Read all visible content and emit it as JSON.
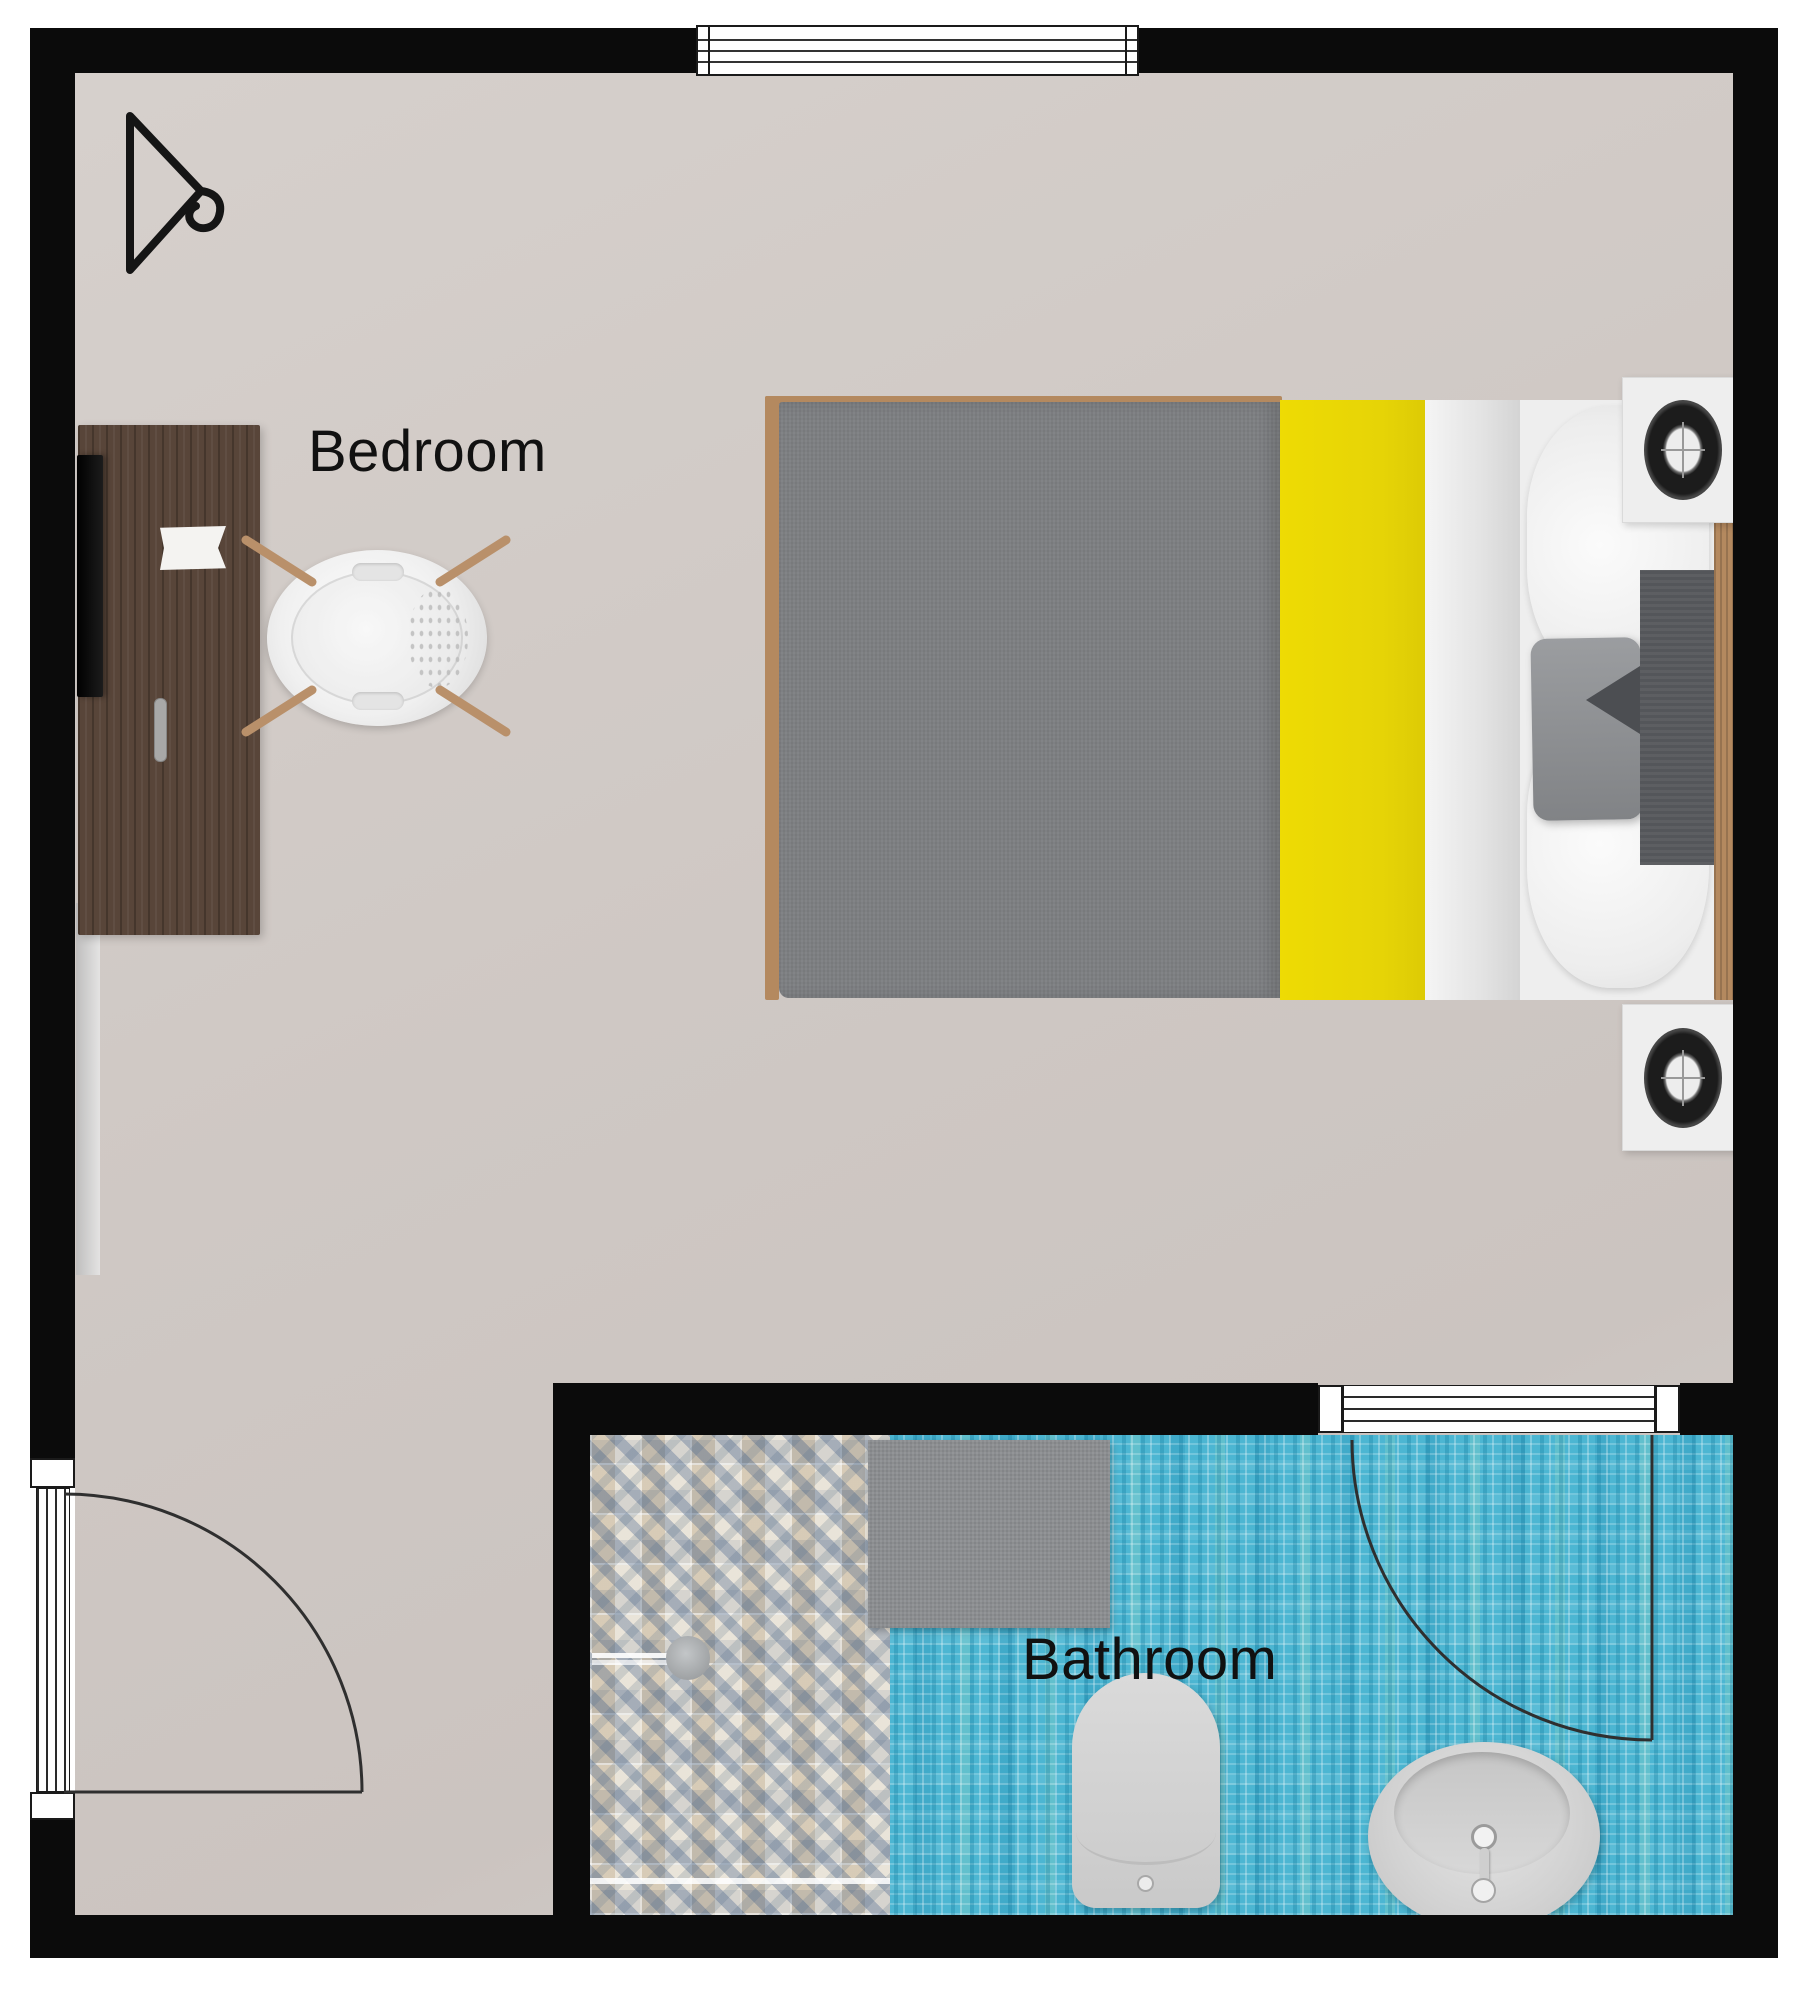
{
  "rooms": {
    "bedroom": {
      "label": "Bedroom"
    },
    "bathroom": {
      "label": "Bathroom"
    }
  },
  "architecture": {
    "walls": "black perimeter walls",
    "openings": [
      "top-window",
      "entry-door-with-swing",
      "bathroom-door-with-swing"
    ]
  },
  "furniture": {
    "bedroom": [
      "hanger-symbol",
      "desk",
      "wall-tv",
      "desk-chair",
      "double-bed",
      "nightstand-top",
      "nightstand-bottom",
      "speaker-top",
      "speaker-bottom"
    ],
    "bathroom": [
      "shower-tile-area",
      "shower-drain",
      "bath-mat",
      "toilet",
      "washbasin"
    ]
  },
  "colors": {
    "wall": "#0b0b0b",
    "bedroom_floor": "#cfc8c4",
    "bathroom_tile": "#4cb6d2",
    "shower_tile_base": "#ded6c8",
    "bed_blanket_gray": "#7e8083",
    "bed_stripe_yellow": "#e8d606",
    "bed_linen_white": "#eeeeee",
    "desk_wood": "#584539",
    "bed_frame_wood": "#b4895f",
    "bath_mat_gray": "#8b8d90",
    "fixture_gray": "#d3d3d3",
    "label_text": "#111111"
  }
}
